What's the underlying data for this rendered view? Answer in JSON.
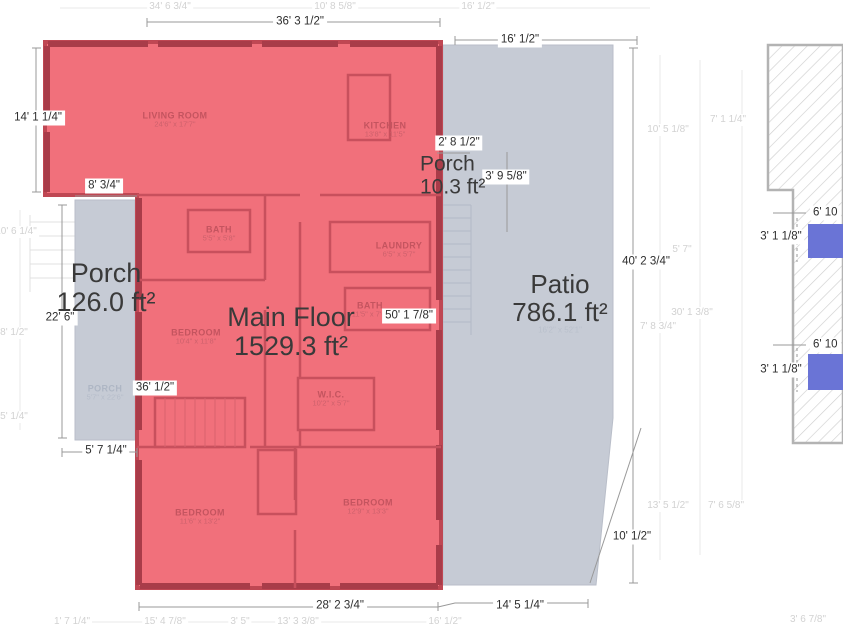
{
  "areas": {
    "porch_left": {
      "label": "Porch",
      "value": "126.0 ft²"
    },
    "main_floor": {
      "label": "Main Floor",
      "value": "1529.3 ft²"
    },
    "patio": {
      "label": "Patio",
      "value": "786.1 ft²",
      "sub": "16'2\" x 52'1\""
    },
    "porch_small": {
      "label": "Porch",
      "value": "10.3 ft²"
    }
  },
  "dims": [
    "36' 3 1/2\"",
    "16' 1/2\"",
    "14' 1 1/4\"",
    "8' 3/4\"",
    "2' 8 1/2\"",
    "3' 9 5/8\"",
    "22' 6\"",
    "36' 1/2\"",
    "5' 7 1/4\"",
    "50' 1 7/8\"",
    "40' 2 3/4\"",
    "10' 1/2\"",
    "28' 2 3/4\"",
    "14' 5 1/4\"",
    "6' 10",
    "3' 1 1/8\"",
    "6' 10",
    "3' 1 1/8\""
  ],
  "rooms": [
    {
      "name": "LIVING ROOM",
      "size": "24'6\" x 17'7\""
    },
    {
      "name": "KITCHEN",
      "size": "13'8\" x 11'5\""
    },
    {
      "name": "BATH",
      "size": "5'5\" x 5'8\""
    },
    {
      "name": "LAUNDRY",
      "size": "6'5\" x 5'7\""
    },
    {
      "name": "BEDROOM",
      "size": "10'4\" x 11'8\""
    },
    {
      "name": "BATH",
      "size": "11'5\" x 7'6\""
    },
    {
      "name": "W.I.C.",
      "size": "10'2\" x 5'7\""
    },
    {
      "name": "BEDROOM",
      "size": "11'6\" x 13'2\""
    },
    {
      "name": "BEDROOM",
      "size": "12'9\" x 13'3\""
    },
    {
      "name": "PORCH",
      "size": "5'7\" x 22'6\""
    }
  ],
  "faint": [
    "34' 6 3/4\"",
    "10' 8 5/8\"",
    "16' 1/2\"",
    "10' 5 1/8\"",
    "7' 1 1/4\"",
    "5' 7\"",
    "30' 1 3/8\"",
    "7' 8 3/4\"",
    "13' 5 1/2\"",
    "7' 6 5/8\"",
    "3' 6 7/8\"",
    "1' 7 1/4\"",
    "15' 4 7/8\"",
    "3' 5\"",
    "13' 3 3/8\"",
    "16' 1/2\"",
    "10' 6 1/4\"",
    "8' 1/2\"",
    "5' 1/4\""
  ],
  "colors": {
    "main_floor_fill": "#f1707b",
    "main_floor_border": "#bf4753",
    "wall_dark": "#a93c49",
    "interior_wall": "#c8505d",
    "porch_patio_fill": "#c6cbd5",
    "highlight_blue": "#6a74d6",
    "hatch_line": "#cfcfcf",
    "hatch_border": "#b3b3b3",
    "dim_line": "#999999",
    "dim_text": "#2d2d2d",
    "faint_text": "#d2d2d2",
    "room_text": "#c4545f"
  }
}
